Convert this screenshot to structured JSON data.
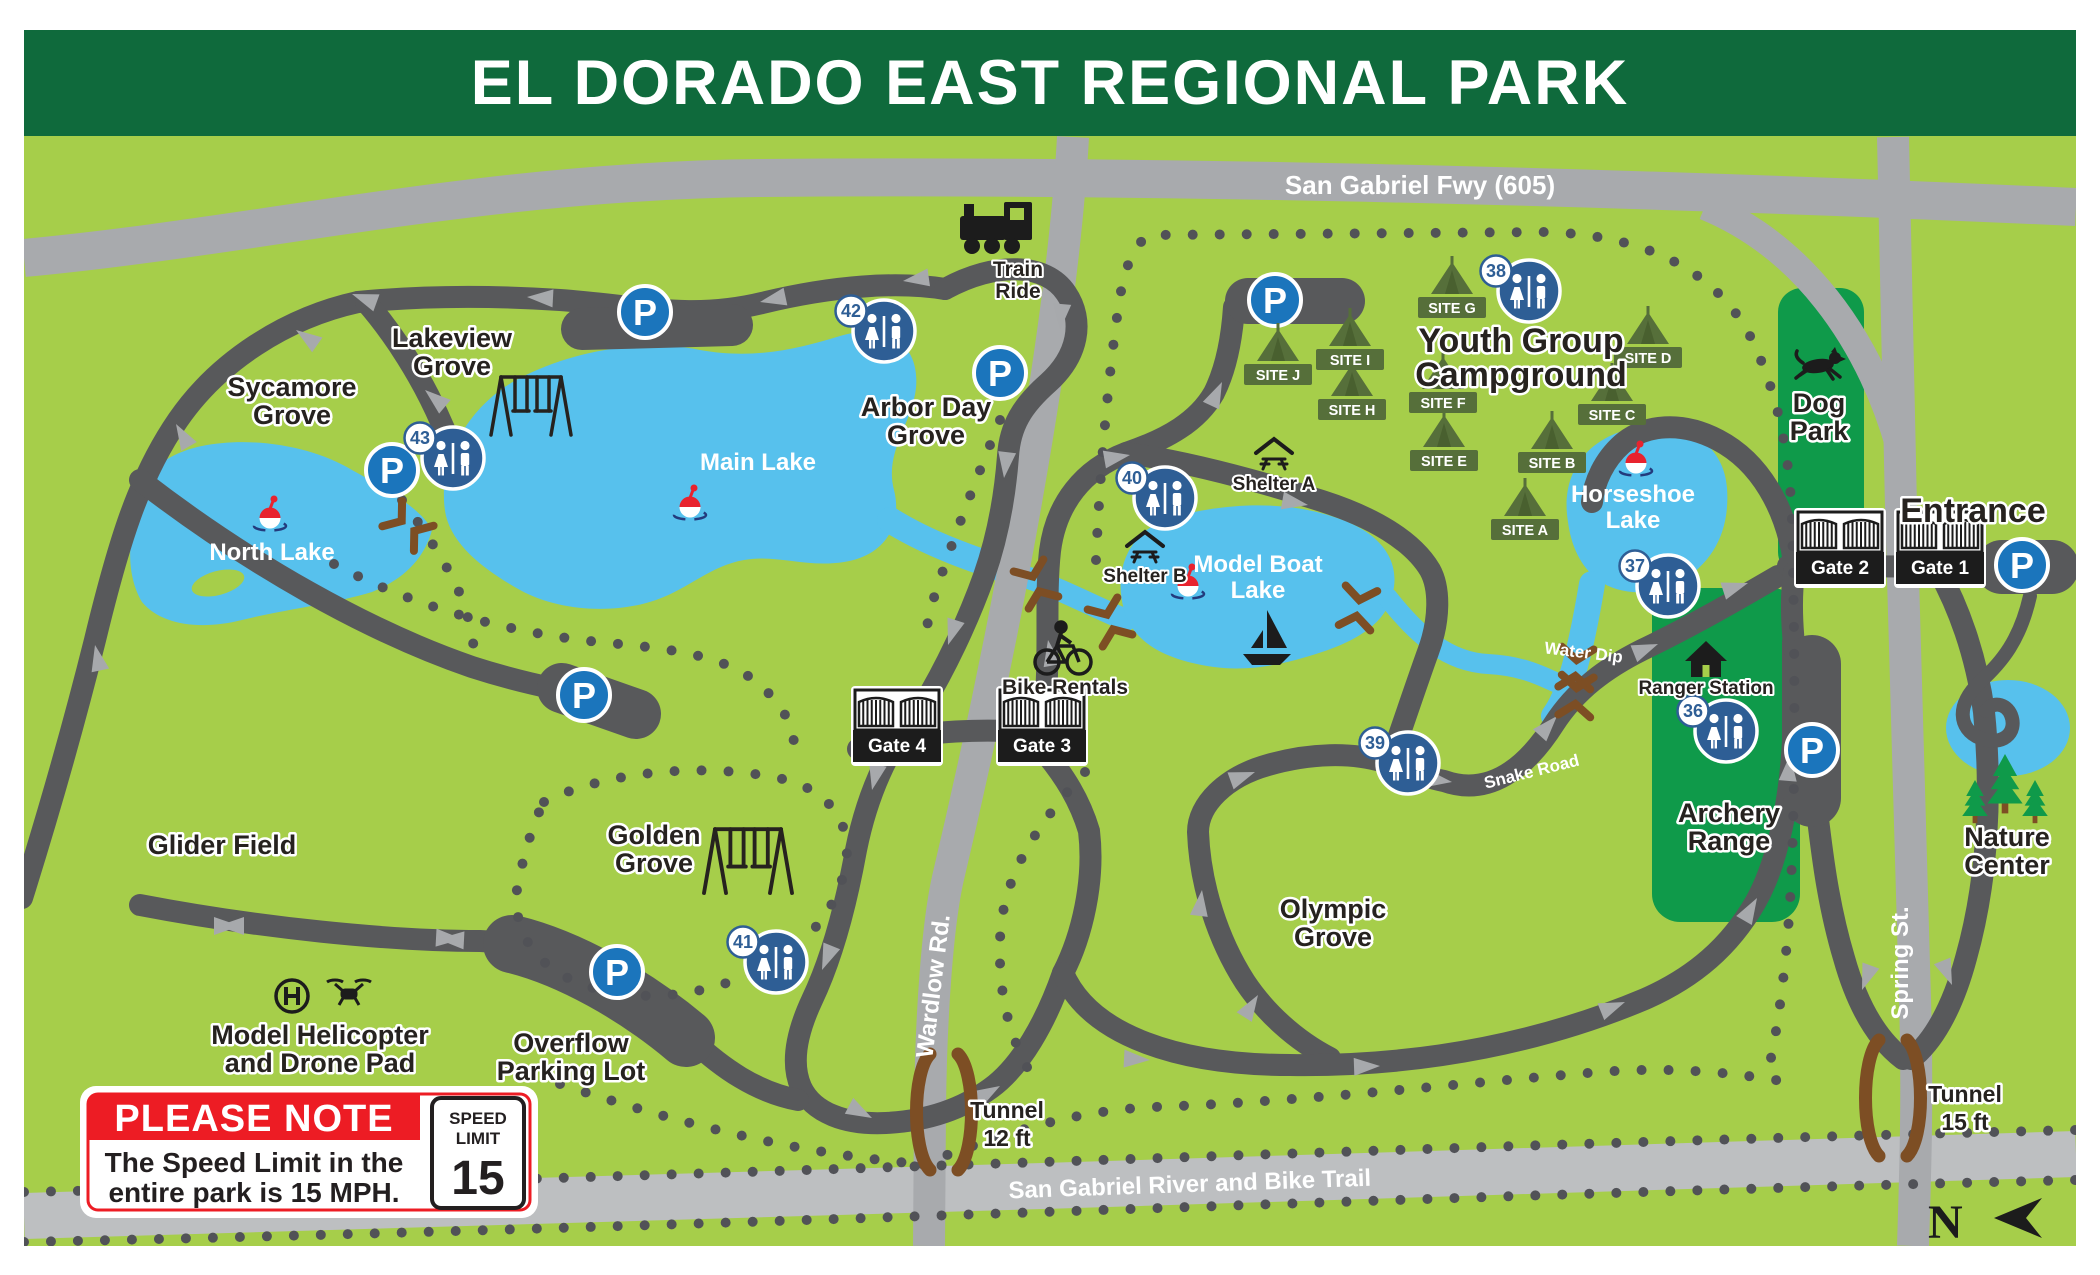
{
  "title": "EL DORADO EAST REGIONAL PARK",
  "colors": {
    "banner_green": "#0f6a3c",
    "map_green": "#a6ce4a",
    "feature_green": "#0f9a4a",
    "tent_olive": "#566f3a",
    "road_dark": "#58595b",
    "road_light": "#a8aaad",
    "river_gray": "#bdbfc1",
    "trail_dot": "#515257",
    "lake_blue": "#57c1ed",
    "restroom_blue": "#2e5e95",
    "parking_blue": "#1b75bc",
    "note_red": "#ed1c24",
    "tunnel_brown": "#7d4e24",
    "text_black": "#26221f"
  },
  "map": {
    "labels": [
      {
        "id": "sycamore-grove",
        "lines": [
          "Sycamore",
          "Grove"
        ],
        "x": 292,
        "y": 396,
        "style": "area"
      },
      {
        "id": "lakeview-grove",
        "lines": [
          "Lakeview",
          "Grove"
        ],
        "x": 452,
        "y": 347,
        "style": "area"
      },
      {
        "id": "arbor-day-grove",
        "lines": [
          "Arbor Day",
          "Grove"
        ],
        "x": 926,
        "y": 416,
        "style": "area"
      },
      {
        "id": "golden-grove",
        "lines": [
          "Golden",
          "Grove"
        ],
        "x": 654,
        "y": 844,
        "style": "area"
      },
      {
        "id": "glider-field",
        "lines": [
          "Glider Field"
        ],
        "x": 222,
        "y": 854,
        "style": "area"
      },
      {
        "id": "overflow-parking-lot",
        "lines": [
          "Overflow",
          "Parking Lot"
        ],
        "x": 571,
        "y": 1052,
        "style": "area"
      },
      {
        "id": "olympic-grove",
        "lines": [
          "Olympic",
          "Grove"
        ],
        "x": 1333,
        "y": 918,
        "style": "area"
      },
      {
        "id": "youth-group-campground",
        "lines": [
          "Youth Group",
          "Campground"
        ],
        "x": 1521,
        "y": 352,
        "style": "areaBig"
      },
      {
        "id": "dog-park",
        "lines": [
          "Dog",
          "Park"
        ],
        "x": 1819,
        "y": 412,
        "style": "area"
      },
      {
        "id": "archery-range",
        "lines": [
          "Archery",
          "Range"
        ],
        "x": 1729,
        "y": 822,
        "style": "area"
      },
      {
        "id": "nature-center",
        "lines": [
          "Nature",
          "Center"
        ],
        "x": 2007,
        "y": 846,
        "style": "area"
      },
      {
        "id": "entrance",
        "lines": [
          "Entrance"
        ],
        "x": 1973,
        "y": 522,
        "style": "areaBig"
      },
      {
        "id": "model-helicopter",
        "lines": [
          "Model Helicopter",
          "and Drone Pad"
        ],
        "x": 320,
        "y": 1044,
        "style": "area"
      },
      {
        "id": "north-lake",
        "lines": [
          "North Lake"
        ],
        "x": 272,
        "y": 560,
        "style": "lake"
      },
      {
        "id": "main-lake",
        "lines": [
          "Main Lake"
        ],
        "x": 758,
        "y": 470,
        "style": "lake"
      },
      {
        "id": "model-boat-lake",
        "lines": [
          "Model Boat",
          "Lake"
        ],
        "x": 1258,
        "y": 572,
        "style": "lake"
      },
      {
        "id": "horseshoe-lake",
        "lines": [
          "Horseshoe",
          "Lake"
        ],
        "x": 1633,
        "y": 502,
        "style": "lake"
      },
      {
        "id": "train-ride",
        "lines": [
          "Train",
          "Ride"
        ],
        "x": 1018,
        "y": 276,
        "style": "small"
      },
      {
        "id": "bike-rentals",
        "lines": [
          "Bike Rentals"
        ],
        "x": 1065,
        "y": 694,
        "style": "small"
      },
      {
        "id": "shelter-a",
        "lines": [
          "Shelter A"
        ],
        "x": 1274,
        "y": 490,
        "style": "tiny"
      },
      {
        "id": "shelter-b",
        "lines": [
          "Shelter B"
        ],
        "x": 1145,
        "y": 582,
        "style": "tiny"
      },
      {
        "id": "ranger-station",
        "lines": [
          "Ranger Station"
        ],
        "x": 1706,
        "y": 694,
        "style": "tiny"
      },
      {
        "id": "san-gabriel-fwy",
        "lines": [
          "San Gabriel Fwy (605)"
        ],
        "x": 1420,
        "y": 194,
        "style": "road26"
      },
      {
        "id": "wardlow-rd",
        "lines": [
          "Wardlow Rd."
        ],
        "x": 941,
        "y": 987,
        "style": "road",
        "rotate": -83
      },
      {
        "id": "spring-st",
        "lines": [
          "Spring St."
        ],
        "x": 1908,
        "y": 963,
        "style": "road",
        "rotate": -90
      },
      {
        "id": "san-gabriel-river-trail",
        "lines": [
          "San Gabriel River and Bike Trail"
        ],
        "x": 1190,
        "y": 1192,
        "style": "road",
        "rotate": -2
      },
      {
        "id": "water-dip",
        "lines": [
          "Water Dip"
        ],
        "x": 1583,
        "y": 658,
        "style": "roadsmall",
        "rotate": 7
      },
      {
        "id": "snake-road",
        "lines": [
          "Snake Road"
        ],
        "x": 1533,
        "y": 777,
        "style": "roadsmall",
        "rotate": -14
      },
      {
        "id": "tunnel-12",
        "lines": [
          "Tunnel",
          "12 ft"
        ],
        "x": 1007,
        "y": 1118,
        "style": "tunnel"
      },
      {
        "id": "tunnel-15",
        "lines": [
          "Tunnel",
          "15 ft"
        ],
        "x": 1965,
        "y": 1102,
        "style": "tunnel"
      }
    ],
    "parking_letter": "P",
    "parking": [
      {
        "x": 645,
        "y": 312
      },
      {
        "x": 392,
        "y": 470
      },
      {
        "x": 1000,
        "y": 373
      },
      {
        "x": 584,
        "y": 695
      },
      {
        "x": 617,
        "y": 972
      },
      {
        "x": 1275,
        "y": 300
      },
      {
        "x": 1812,
        "y": 750
      },
      {
        "x": 2022,
        "y": 565
      }
    ],
    "restrooms": [
      {
        "number": "36",
        "x": 1726,
        "y": 731
      },
      {
        "number": "37",
        "x": 1668,
        "y": 586
      },
      {
        "number": "38",
        "x": 1529,
        "y": 291
      },
      {
        "number": "39",
        "x": 1408,
        "y": 763
      },
      {
        "number": "40",
        "x": 1165,
        "y": 498
      },
      {
        "number": "41",
        "x": 776,
        "y": 962
      },
      {
        "number": "42",
        "x": 884,
        "y": 331
      },
      {
        "number": "43",
        "x": 453,
        "y": 458
      }
    ],
    "campsites": [
      {
        "label": "SITE A",
        "x": 1525,
        "y": 530
      },
      {
        "label": "SITE B",
        "x": 1552,
        "y": 463
      },
      {
        "label": "SITE C",
        "x": 1612,
        "y": 415
      },
      {
        "label": "SITE D",
        "x": 1648,
        "y": 358
      },
      {
        "label": "SITE E",
        "x": 1444,
        "y": 461
      },
      {
        "label": "SITE F",
        "x": 1443,
        "y": 403
      },
      {
        "label": "SITE G",
        "x": 1452,
        "y": 308
      },
      {
        "label": "SITE H",
        "x": 1352,
        "y": 410
      },
      {
        "label": "SITE I",
        "x": 1350,
        "y": 360
      },
      {
        "label": "SITE J",
        "x": 1278,
        "y": 375
      }
    ],
    "gates": [
      {
        "label": "Gate 1",
        "x": 1940,
        "y": 556
      },
      {
        "label": "Gate 2",
        "x": 1840,
        "y": 556
      },
      {
        "label": "Gate 3",
        "x": 1042,
        "y": 734
      },
      {
        "label": "Gate 4",
        "x": 897,
        "y": 734
      }
    ],
    "bobbers": [
      {
        "x": 270,
        "y": 518
      },
      {
        "x": 690,
        "y": 507
      },
      {
        "x": 1188,
        "y": 586
      },
      {
        "x": 1636,
        "y": 463
      }
    ],
    "swings": [
      {
        "x": 531,
        "y": 405,
        "s": 1.0
      },
      {
        "x": 748,
        "y": 860,
        "s": 1.1
      }
    ],
    "bridges": [
      {
        "x": 408,
        "y": 526,
        "r": 38
      },
      {
        "x": 1036,
        "y": 584,
        "r": 68
      },
      {
        "x": 1110,
        "y": 622,
        "r": 68
      },
      {
        "x": 1358,
        "y": 608,
        "r": 100
      },
      {
        "x": 1576,
        "y": 668,
        "r": 95
      },
      {
        "x": 1576,
        "y": 696,
        "r": 95
      }
    ],
    "tunnels": [
      {
        "x": 944,
        "y": 1112
      },
      {
        "x": 1893,
        "y": 1098
      }
    ],
    "arrows": [
      [
        527,
        297,
        183
      ],
      [
        352,
        294,
        200
      ],
      [
        296,
        330,
        215
      ],
      [
        176,
        424,
        240
      ],
      [
        95,
        645,
        258
      ],
      [
        760,
        302,
        168
      ],
      [
        903,
        281,
        172
      ],
      [
        1060,
        330,
        95
      ],
      [
        1004,
        478,
        97
      ],
      [
        948,
        645,
        108
      ],
      [
        872,
        790,
        103
      ],
      [
        822,
        970,
        112
      ],
      [
        872,
        1118,
        28
      ],
      [
        1000,
        1086,
        -30
      ],
      [
        1150,
        1060,
        3
      ],
      [
        1380,
        1066,
        -2
      ],
      [
        1625,
        1002,
        -22
      ],
      [
        1757,
        898,
        -60
      ],
      [
        1790,
        755,
        -85
      ],
      [
        1258,
        995,
        -58
      ],
      [
        1202,
        890,
        -83
      ],
      [
        1255,
        772,
        -20
      ],
      [
        1452,
        782,
        8
      ],
      [
        1557,
        716,
        -48
      ],
      [
        1658,
        644,
        -22
      ],
      [
        1748,
        583,
        -18
      ],
      [
        240,
        926,
        0
      ],
      [
        218,
        926,
        180
      ],
      [
        462,
        939,
        3
      ],
      [
        438,
        939,
        183
      ],
      [
        1048,
        640,
        -100
      ],
      [
        1222,
        382,
        -65
      ],
      [
        1130,
        455,
        -10
      ],
      [
        1308,
        505,
        10
      ],
      [
        1862,
        990,
        110
      ],
      [
        1952,
        985,
        68
      ],
      [
        425,
        390,
        220
      ]
    ],
    "icons": {
      "train": {
        "x": 996,
        "y": 230
      },
      "bike": {
        "x": 1063,
        "y": 652
      },
      "sailboat": {
        "x": 1266,
        "y": 646
      },
      "shelter_a": {
        "x": 1274,
        "y": 455
      },
      "shelter_b": {
        "x": 1145,
        "y": 548
      },
      "ranger": {
        "x": 1706,
        "y": 658
      },
      "dog": {
        "x": 1818,
        "y": 366
      },
      "helipad": {
        "x": 292,
        "y": 996
      },
      "drone": {
        "x": 349,
        "y": 992
      },
      "pines": {
        "x": 2005,
        "y": 806
      }
    }
  },
  "note": {
    "heading": "PLEASE NOTE",
    "body_line1": "The Speed Limit in the",
    "body_line2": "entire park is 15 MPH.",
    "sign_line1": "SPEED",
    "sign_line2": "LIMIT",
    "sign_value": "15"
  },
  "compass": {
    "letter": "N"
  }
}
